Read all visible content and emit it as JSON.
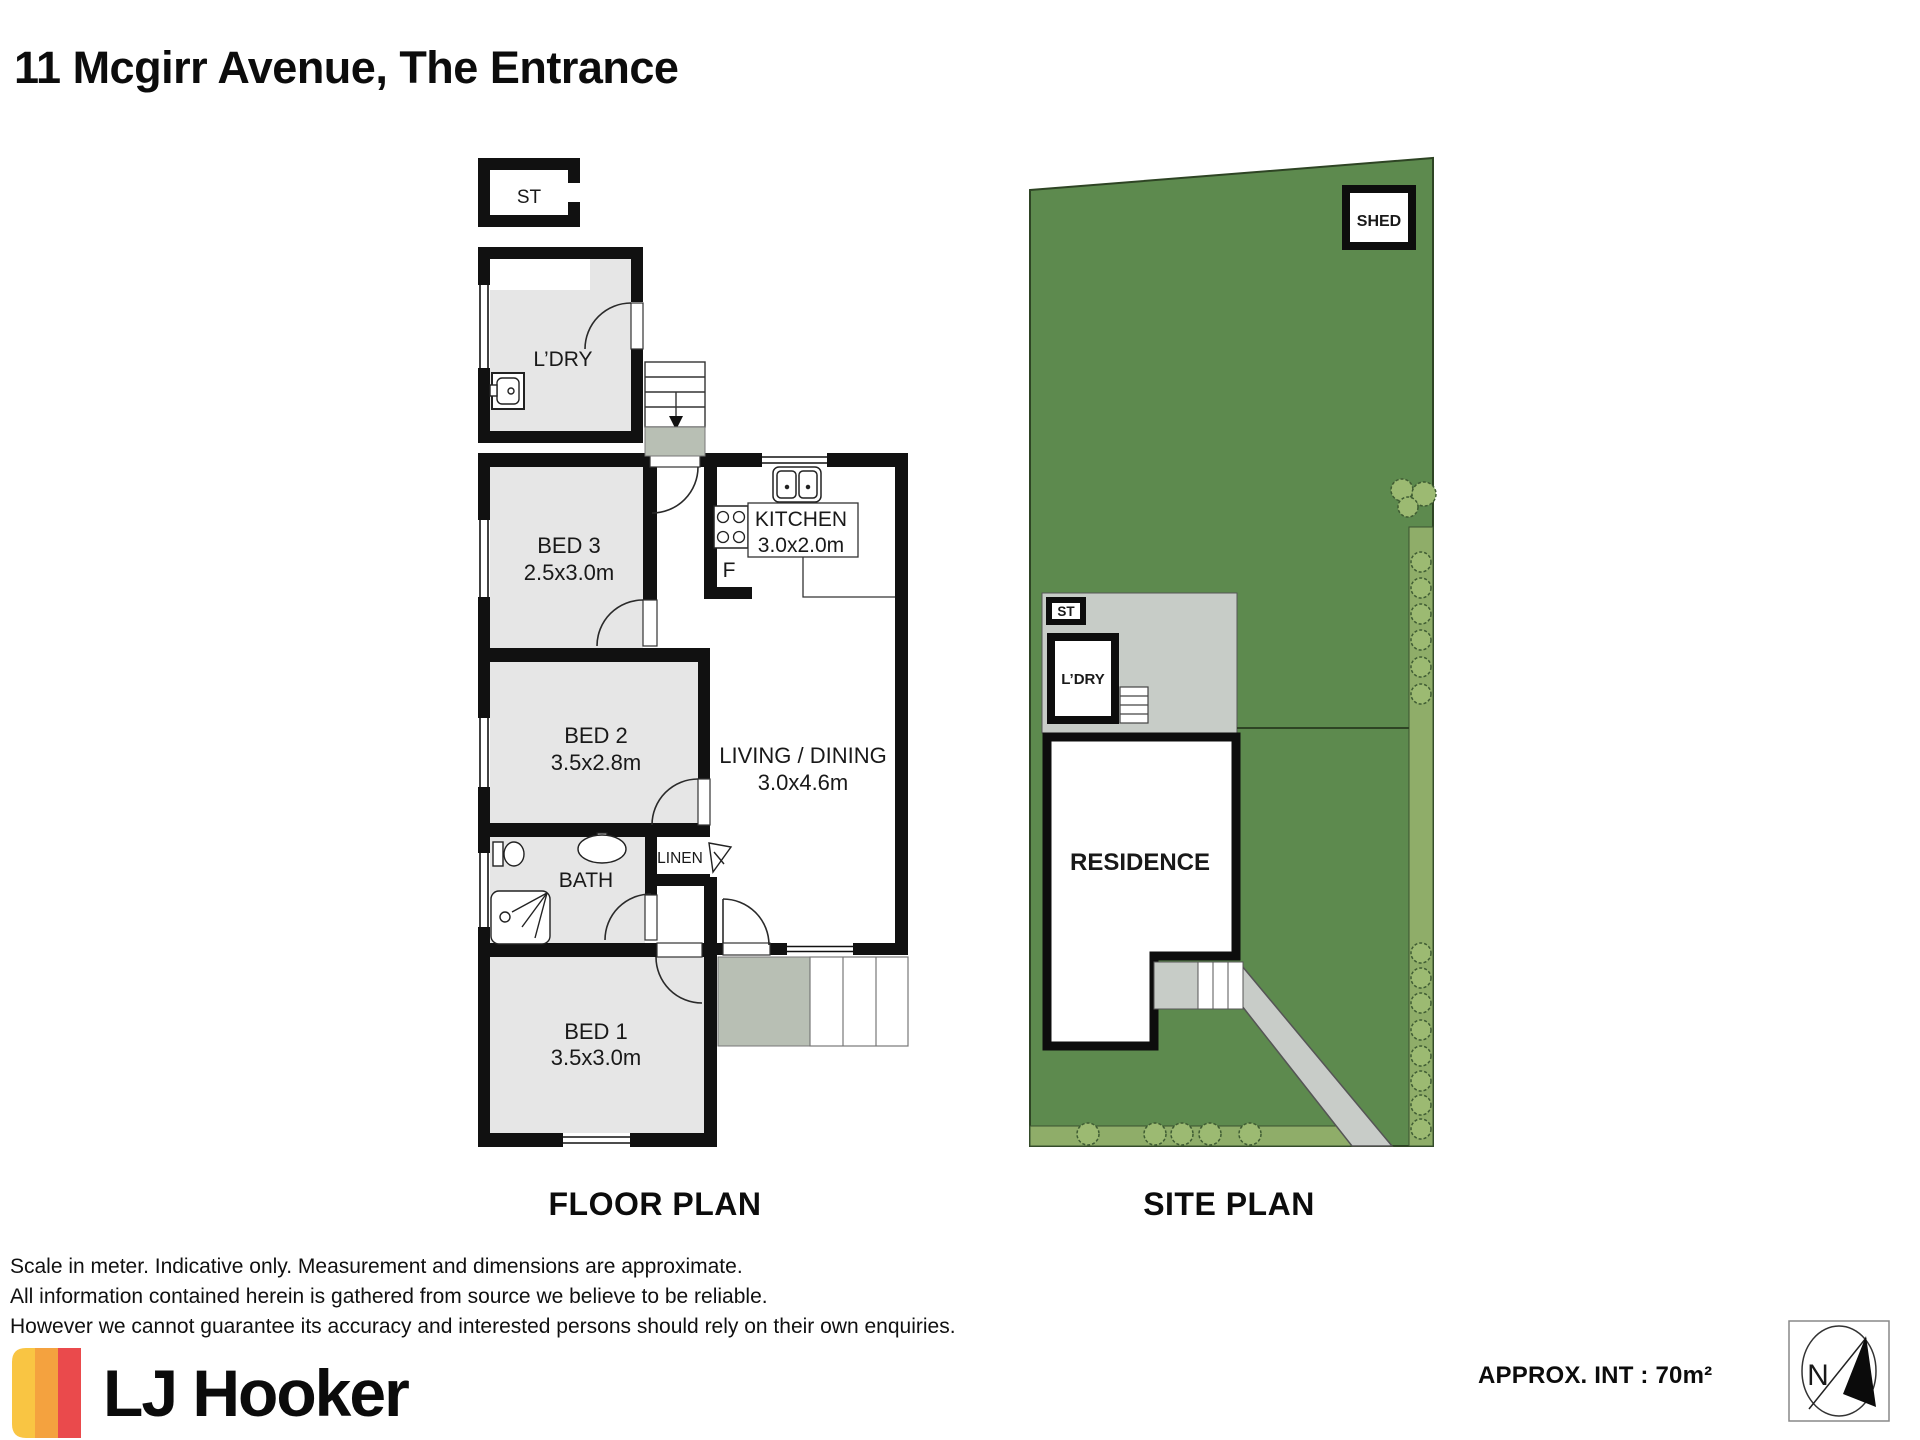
{
  "title": "11 Mcgirr Avenue, The Entrance",
  "floor_plan": {
    "caption": "FLOOR PLAN",
    "labels": {
      "st": "ST",
      "ldry": "L’DRY",
      "bed3": "BED 3",
      "bed3_dims": "2.5x3.0m",
      "kitchen": "KITCHEN",
      "kitchen_dims": "3.0x2.0m",
      "fridge": "F",
      "bed2": "BED 2",
      "bed2_dims": "3.5x2.8m",
      "living": "LIVING / DINING",
      "living_dims": "3.0x4.6m",
      "bath": "BATH",
      "linen": "LINEN",
      "bed1": "BED 1",
      "bed1_dims": "3.5x3.0m"
    }
  },
  "site_plan": {
    "caption": "SITE PLAN",
    "labels": {
      "shed": "SHED",
      "st": "ST",
      "ldry": "L’DRY",
      "residence": "RESIDENCE"
    }
  },
  "disclaimer": {
    "line1": "Scale in meter. Indicative  only. Measurement and dimensions are approximate.",
    "line2": "All information contained herein is gathered from source we believe to be reliable.",
    "line3": "However we cannot guarantee its accuracy and interested persons should rely on their own enquiries."
  },
  "brand": {
    "name": "LJ Hooker"
  },
  "footer": {
    "approx_area": "APPROX. INT : 70m²"
  },
  "compass": {
    "north": "N"
  },
  "colors": {
    "wall_black": "#111111",
    "room_gray": "#e6e6e6",
    "landing_gray": "#b8bfb4",
    "patio_gray": "#c7ccc7",
    "path_gray": "#c8ccc8",
    "lot_green": "#5d8a4e",
    "garden_green": "#8fad69",
    "bush_green": "#9cba72",
    "brand_yellow": "#f9c543",
    "brand_orange": "#f4a23f",
    "brand_red": "#ea4a4c"
  }
}
